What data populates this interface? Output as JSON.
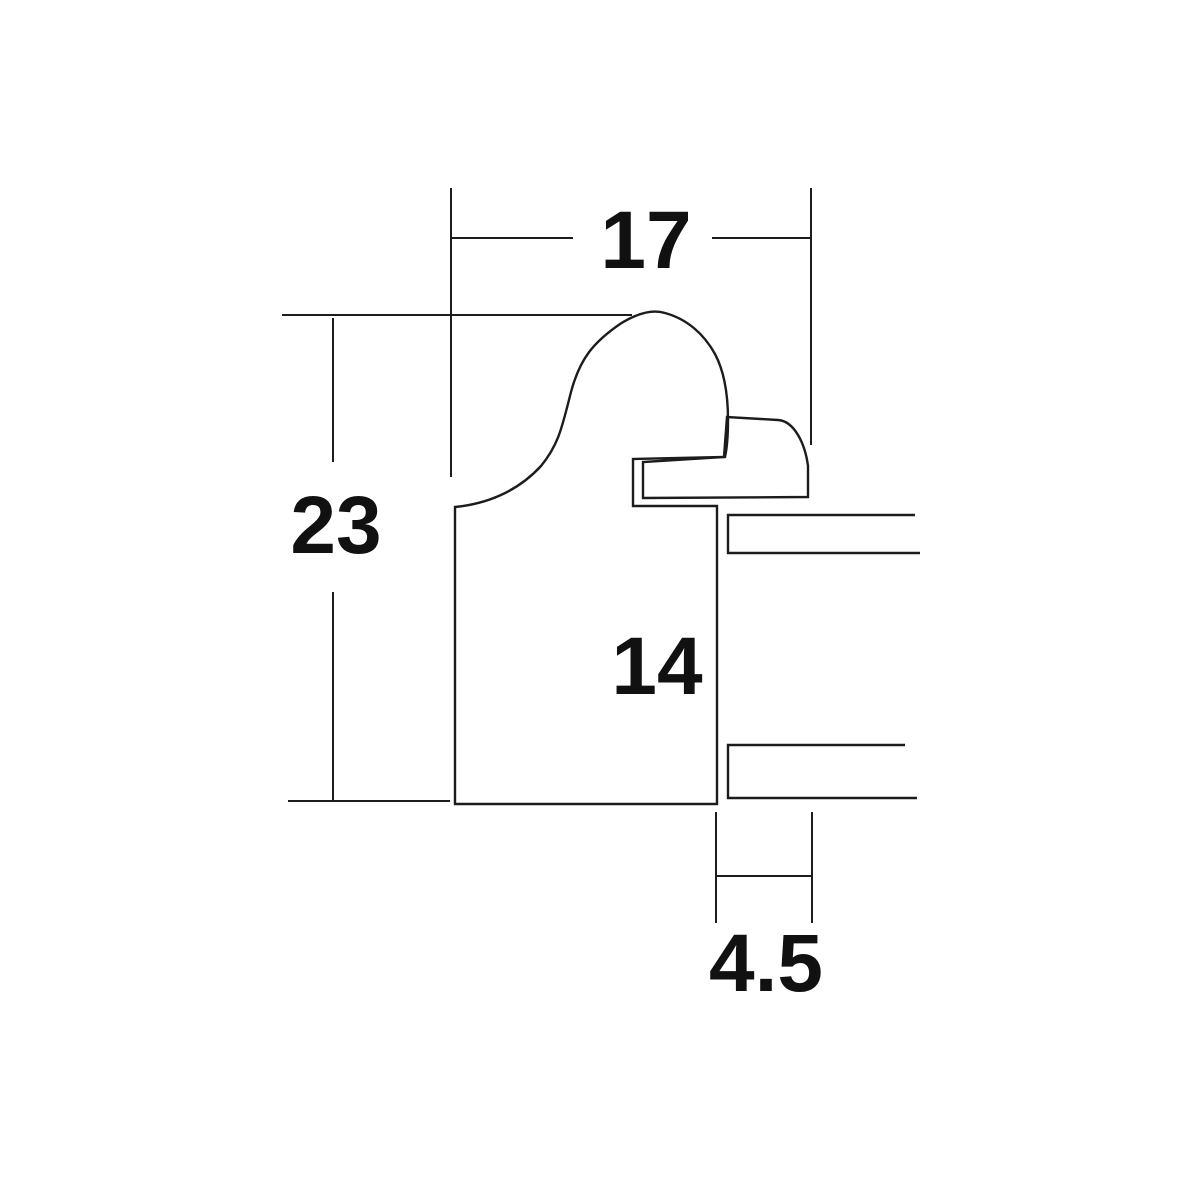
{
  "diagram": {
    "kind": "frame-moulding-cross-section",
    "background_color": "#ffffff",
    "line_color": "#1c1c1c",
    "text_color": "#111111",
    "dimensions": {
      "overall_width": {
        "value": 17,
        "label": "17"
      },
      "overall_height": {
        "value": 23,
        "label": "23"
      },
      "rabbet_height": {
        "value": 14,
        "label": "14"
      },
      "lip_width": {
        "value": 4.5,
        "label": "4.5"
      }
    }
  }
}
